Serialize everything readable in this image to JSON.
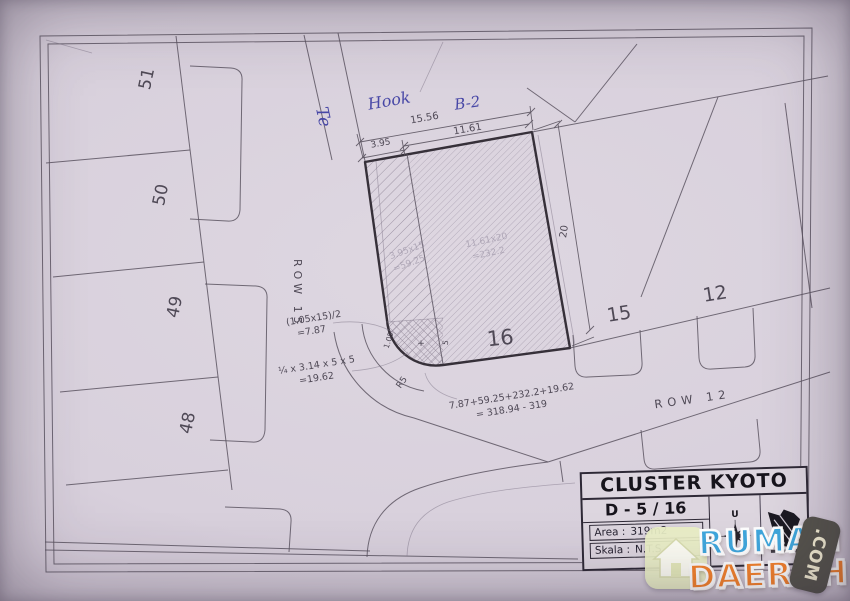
{
  "handwriting": {
    "side_note": "Te",
    "hook": "Hook",
    "block": "B-2"
  },
  "left_plots": [
    "51",
    "50",
    "49",
    "48"
  ],
  "rows": {
    "row15": "ROW 15",
    "row12": "ROW 12"
  },
  "dims": {
    "total": "15.56",
    "main": "11.61",
    "strip": "3.95",
    "depth": "20"
  },
  "plots": {
    "subject": "16",
    "right1": "15",
    "right2": "12"
  },
  "calc": {
    "strip_formula": "3.95x15",
    "strip_result": "=59.25",
    "main_formula": "11.61x20",
    "main_result": "=232.2",
    "triangle_formula": "(1.05x15)/2",
    "triangle_result": "=7.87",
    "quarter_formula": "¼ x 3.14 x 5 x 5",
    "quarter_result": "=19.62",
    "sum_formula": "7.87+59.25+232.2+19.62",
    "sum_result": "= 318.94 - 319",
    "radius": "R5",
    "offset": "1.05",
    "plus": "+",
    "radius_leg": "5"
  },
  "title_block": {
    "title": "CLUSTER KYOTO",
    "unit": "D - 5 / 16",
    "area_label": "Area :",
    "area_value": "319m2",
    "scale_label": "Skala :",
    "scale_value": "N.T.S",
    "north_label": "U"
  },
  "watermark": {
    "word1": "RUMAH",
    "word2": "DAERAH",
    "tld": ".COM"
  },
  "colors": {
    "paper": "#d9d2dc",
    "ink": "#57505c",
    "bold_ink": "#363039",
    "blue_pen": "#4747a6",
    "wm_blue": "#3fa7dd",
    "wm_orange": "#f5822c"
  }
}
